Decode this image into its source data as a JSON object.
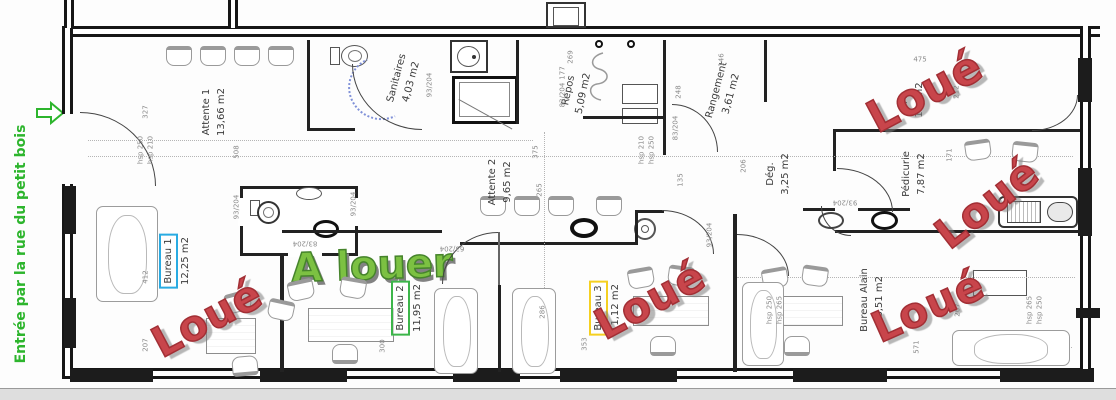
{
  "plan": {
    "entrance": {
      "label": "Entrée par la rue du petit bois",
      "color": "#2db52d",
      "arrow_icon": "right-arrow"
    },
    "marketing": {
      "a_louer": {
        "text": "A louer",
        "color": "#7cc142",
        "x": 372,
        "y": 266,
        "size": 40,
        "rot": -2
      },
      "loue_color": "#c8454b",
      "stamps": [
        {
          "text": "Loué",
          "room": "bureau-1",
          "x": 207,
          "y": 318,
          "rot": -28,
          "size": 42
        },
        {
          "text": "Loué",
          "room": "bureau-3",
          "x": 650,
          "y": 300,
          "rot": -28,
          "size": 42
        },
        {
          "text": "Loué",
          "room": "room-a",
          "x": 925,
          "y": 92,
          "rot": -28,
          "size": 44
        },
        {
          "text": "Loué",
          "room": "pedicurie",
          "x": 987,
          "y": 203,
          "rot": -38,
          "size": 42
        },
        {
          "text": "Loué",
          "room": "bureau-alain",
          "x": 928,
          "y": 306,
          "rot": -24,
          "size": 42
        }
      ]
    },
    "rooms": [
      {
        "id": "attente-1",
        "name": "Attente 1",
        "area": "13,66 m2",
        "x": 214,
        "y": 112,
        "rot": -90
      },
      {
        "id": "sanitaires",
        "name": "Sanitaires",
        "area": "4,03 m2",
        "x": 404,
        "y": 80,
        "rot": -75
      },
      {
        "id": "repos",
        "name": "Repos",
        "area": "5,09 m2",
        "x": 576,
        "y": 92,
        "rot": -78
      },
      {
        "id": "rangement",
        "name": "Rangement",
        "area": "3,61 m2",
        "x": 724,
        "y": 92,
        "rot": -75
      },
      {
        "id": "attente-2",
        "name": "Attente 2",
        "area": "9,65 m2",
        "x": 500,
        "y": 182,
        "rot": -90
      },
      {
        "id": "room-a",
        "name": "A",
        "area": "10, m2",
        "x": 912,
        "y": 100,
        "rot": -90
      },
      {
        "id": "degagement",
        "name": "Dég.",
        "area": "3,25 m2",
        "x": 778,
        "y": 174,
        "rot": -90
      },
      {
        "id": "pedicurie",
        "name": "Pédicurie",
        "area": "7,87 m2",
        "x": 914,
        "y": 174,
        "rot": -90
      },
      {
        "id": "bureau-1",
        "name": "Bureau 1",
        "area": "12,25 m2",
        "x": 176,
        "y": 261,
        "rot": -90,
        "box_color": "#29abe2"
      },
      {
        "id": "bureau-2",
        "name": "Bureau 2",
        "area": "11,95 m2",
        "x": 408,
        "y": 308,
        "rot": -90,
        "box_color": "#3cb54a"
      },
      {
        "id": "bureau-3",
        "name": "Bureau 3",
        "area": "11,12 m2",
        "x": 606,
        "y": 308,
        "rot": -90,
        "box_color": "#f5d021"
      },
      {
        "id": "bureau-alain",
        "name": "Bureau Alain",
        "area": "16,51 m2",
        "x": 872,
        "y": 300,
        "rot": -90
      }
    ],
    "dimensions": [
      {
        "t": "327",
        "x": 146,
        "y": 112,
        "r": -90
      },
      {
        "t": "hsp 250",
        "x": 141,
        "y": 150,
        "r": -90
      },
      {
        "t": "hsp 210",
        "x": 151,
        "y": 150,
        "r": -90
      },
      {
        "t": "508",
        "x": 237,
        "y": 152,
        "r": -90
      },
      {
        "t": "93/204",
        "x": 430,
        "y": 85,
        "r": -90
      },
      {
        "t": "93/204",
        "x": 237,
        "y": 207,
        "r": -90
      },
      {
        "t": "93/204",
        "x": 354,
        "y": 204,
        "r": -90
      },
      {
        "t": "83/204",
        "x": 305,
        "y": 243,
        "r": 180
      },
      {
        "t": "63/204",
        "x": 452,
        "y": 248,
        "r": 180
      },
      {
        "t": "375",
        "x": 536,
        "y": 152,
        "r": -90
      },
      {
        "t": "265",
        "x": 540,
        "y": 190,
        "r": -90
      },
      {
        "t": "269",
        "x": 571,
        "y": 57,
        "r": -90
      },
      {
        "t": "177",
        "x": 563,
        "y": 73,
        "r": -90
      },
      {
        "t": "83/204",
        "x": 563,
        "y": 95,
        "r": -90
      },
      {
        "t": "146",
        "x": 722,
        "y": 60,
        "r": -90
      },
      {
        "t": "248",
        "x": 679,
        "y": 92,
        "r": -90
      },
      {
        "t": "83/204",
        "x": 676,
        "y": 128,
        "r": -90
      },
      {
        "t": "hsp 210",
        "x": 642,
        "y": 150,
        "r": -90
      },
      {
        "t": "hsp 250",
        "x": 652,
        "y": 150,
        "r": -90
      },
      {
        "t": "135",
        "x": 681,
        "y": 180,
        "r": -90
      },
      {
        "t": "206",
        "x": 744,
        "y": 166,
        "r": -90
      },
      {
        "t": "475",
        "x": 920,
        "y": 60,
        "r": 0
      },
      {
        "t": "212",
        "x": 957,
        "y": 92,
        "r": -90
      },
      {
        "t": "171",
        "x": 950,
        "y": 155,
        "r": -90
      },
      {
        "t": "93/204",
        "x": 845,
        "y": 202,
        "r": 180
      },
      {
        "t": "412",
        "x": 146,
        "y": 277,
        "r": -90
      },
      {
        "t": "207",
        "x": 146,
        "y": 345,
        "r": -90
      },
      {
        "t": "300",
        "x": 383,
        "y": 346,
        "r": -90
      },
      {
        "t": "353",
        "x": 585,
        "y": 344,
        "r": -90
      },
      {
        "t": "286",
        "x": 543,
        "y": 312,
        "r": -90
      },
      {
        "t": "93/204",
        "x": 710,
        "y": 235,
        "r": -90
      },
      {
        "t": "hsp 250",
        "x": 770,
        "y": 310,
        "r": -90
      },
      {
        "t": "hsp 265",
        "x": 780,
        "y": 310,
        "r": -90
      },
      {
        "t": "571",
        "x": 917,
        "y": 347,
        "r": -90
      },
      {
        "t": "267",
        "x": 958,
        "y": 310,
        "r": -90
      },
      {
        "t": "hsp 265",
        "x": 1030,
        "y": 310,
        "r": -90
      },
      {
        "t": "hsp 250",
        "x": 1040,
        "y": 310,
        "r": -90
      }
    ]
  }
}
